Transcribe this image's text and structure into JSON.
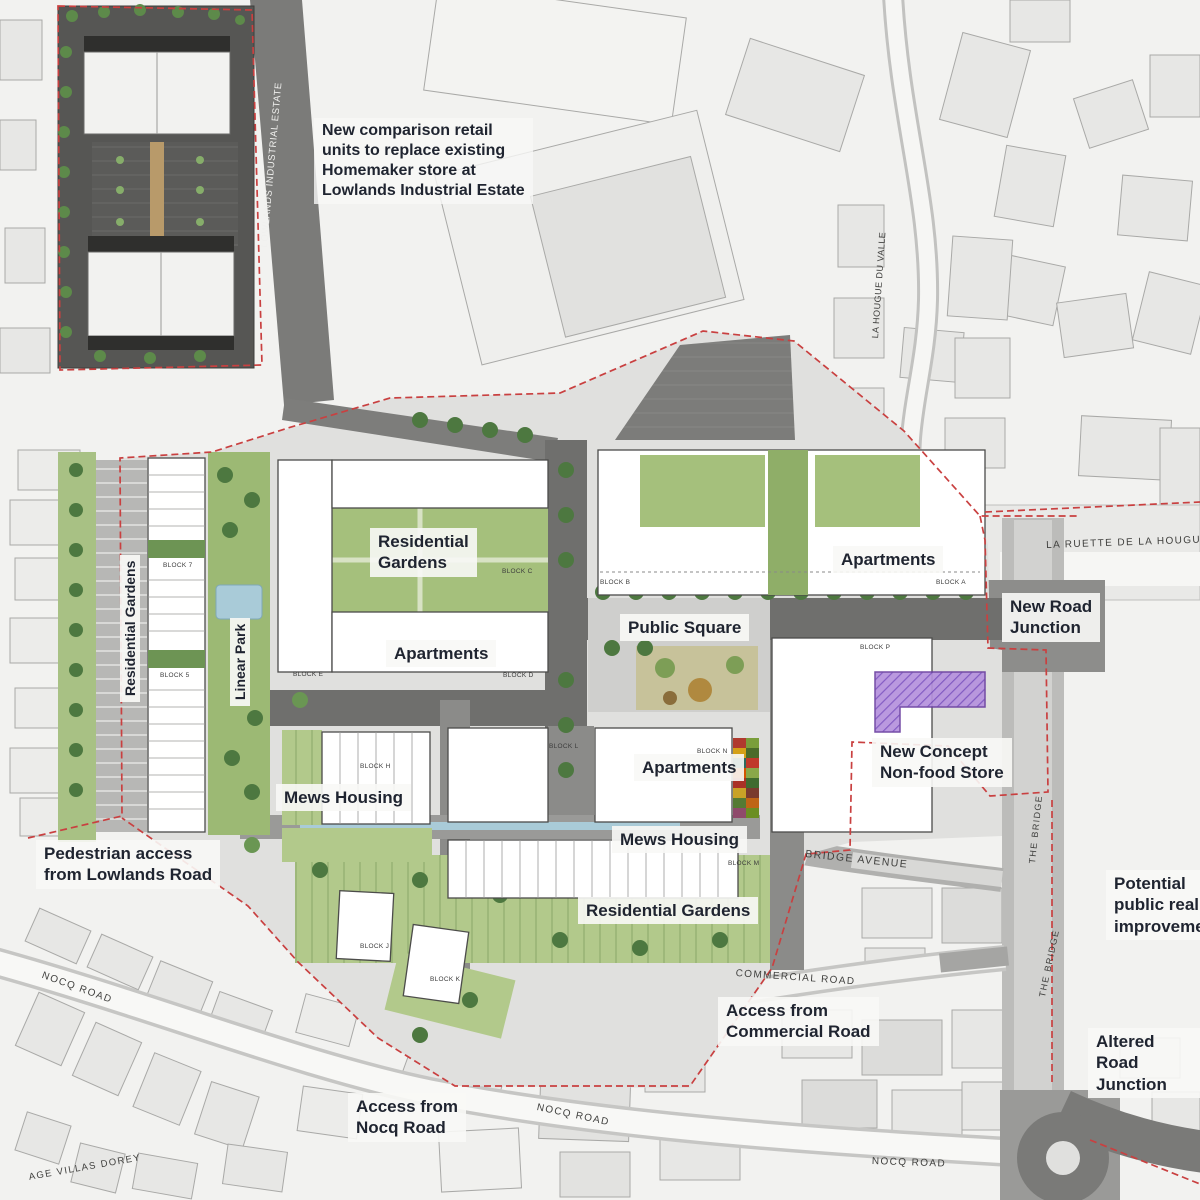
{
  "callouts": {
    "retail_note": "New comparison retail\nunits to replace existing\nHomemaker store at\nLowlands Industrial Estate",
    "residential_gardens_west": "Residential Gardens",
    "linear_park": "Linear Park",
    "residential_gardens_block_c": "Residential\nGardens",
    "apartments_block_d": "Apartments",
    "apartments_north_east": "Apartments",
    "public_square": "Public Square",
    "new_road_junction": "New Road\nJunction",
    "apartments_block_n": "Apartments",
    "mews_housing_west": "Mews Housing",
    "mews_housing_south": "Mews Housing",
    "residential_gardens_south": "Residential Gardens",
    "new_concept_store": "New Concept\nNon-food Store",
    "pedestrian_access": "Pedestrian access\nfrom Lowlands Road",
    "access_commercial": "Access from\nCommercial Road",
    "access_nocq": "Access from\nNocq Road",
    "public_realm": "Potential\npublic realm\nimprovement",
    "altered_junction": "Altered Road\nJunction"
  },
  "roads": {
    "lowlands_industrial_estate": "LOWLANDS INDUSTRIAL ESTATE",
    "la_hougue_du_valle": "LA HOUGUE DU VALLE",
    "la_ruette": "LA RUETTE DE LA HOUGUE D",
    "bridge_avenue": "BRIDGE AVENUE",
    "commercial_road": "COMMERCIAL ROAD",
    "the_bridge": "THE BRIDGE",
    "nocq_road": "NOCQ ROAD",
    "villas_dorey": "AGE VILLAS DOREY"
  },
  "blocks": [
    "BLOCK 7",
    "BLOCK 5",
    "BLOCK E",
    "BLOCK C",
    "BLOCK D",
    "BLOCK B",
    "BLOCK A",
    "BLOCK P",
    "BLOCK L",
    "BLOCK N",
    "BLOCK M",
    "BLOCK H",
    "BLOCK J",
    "BLOCK K"
  ],
  "colors": {
    "site_boundary": "#c94040",
    "store_highlight": "#8a5bc4",
    "water": "#a9cbd8",
    "landscape_green": "#a5c07c",
    "tree_green": "#4d7840",
    "street_dark": "#6f6f6d",
    "label_text": "#1f2430",
    "label_bg": "#f6f6f4"
  }
}
